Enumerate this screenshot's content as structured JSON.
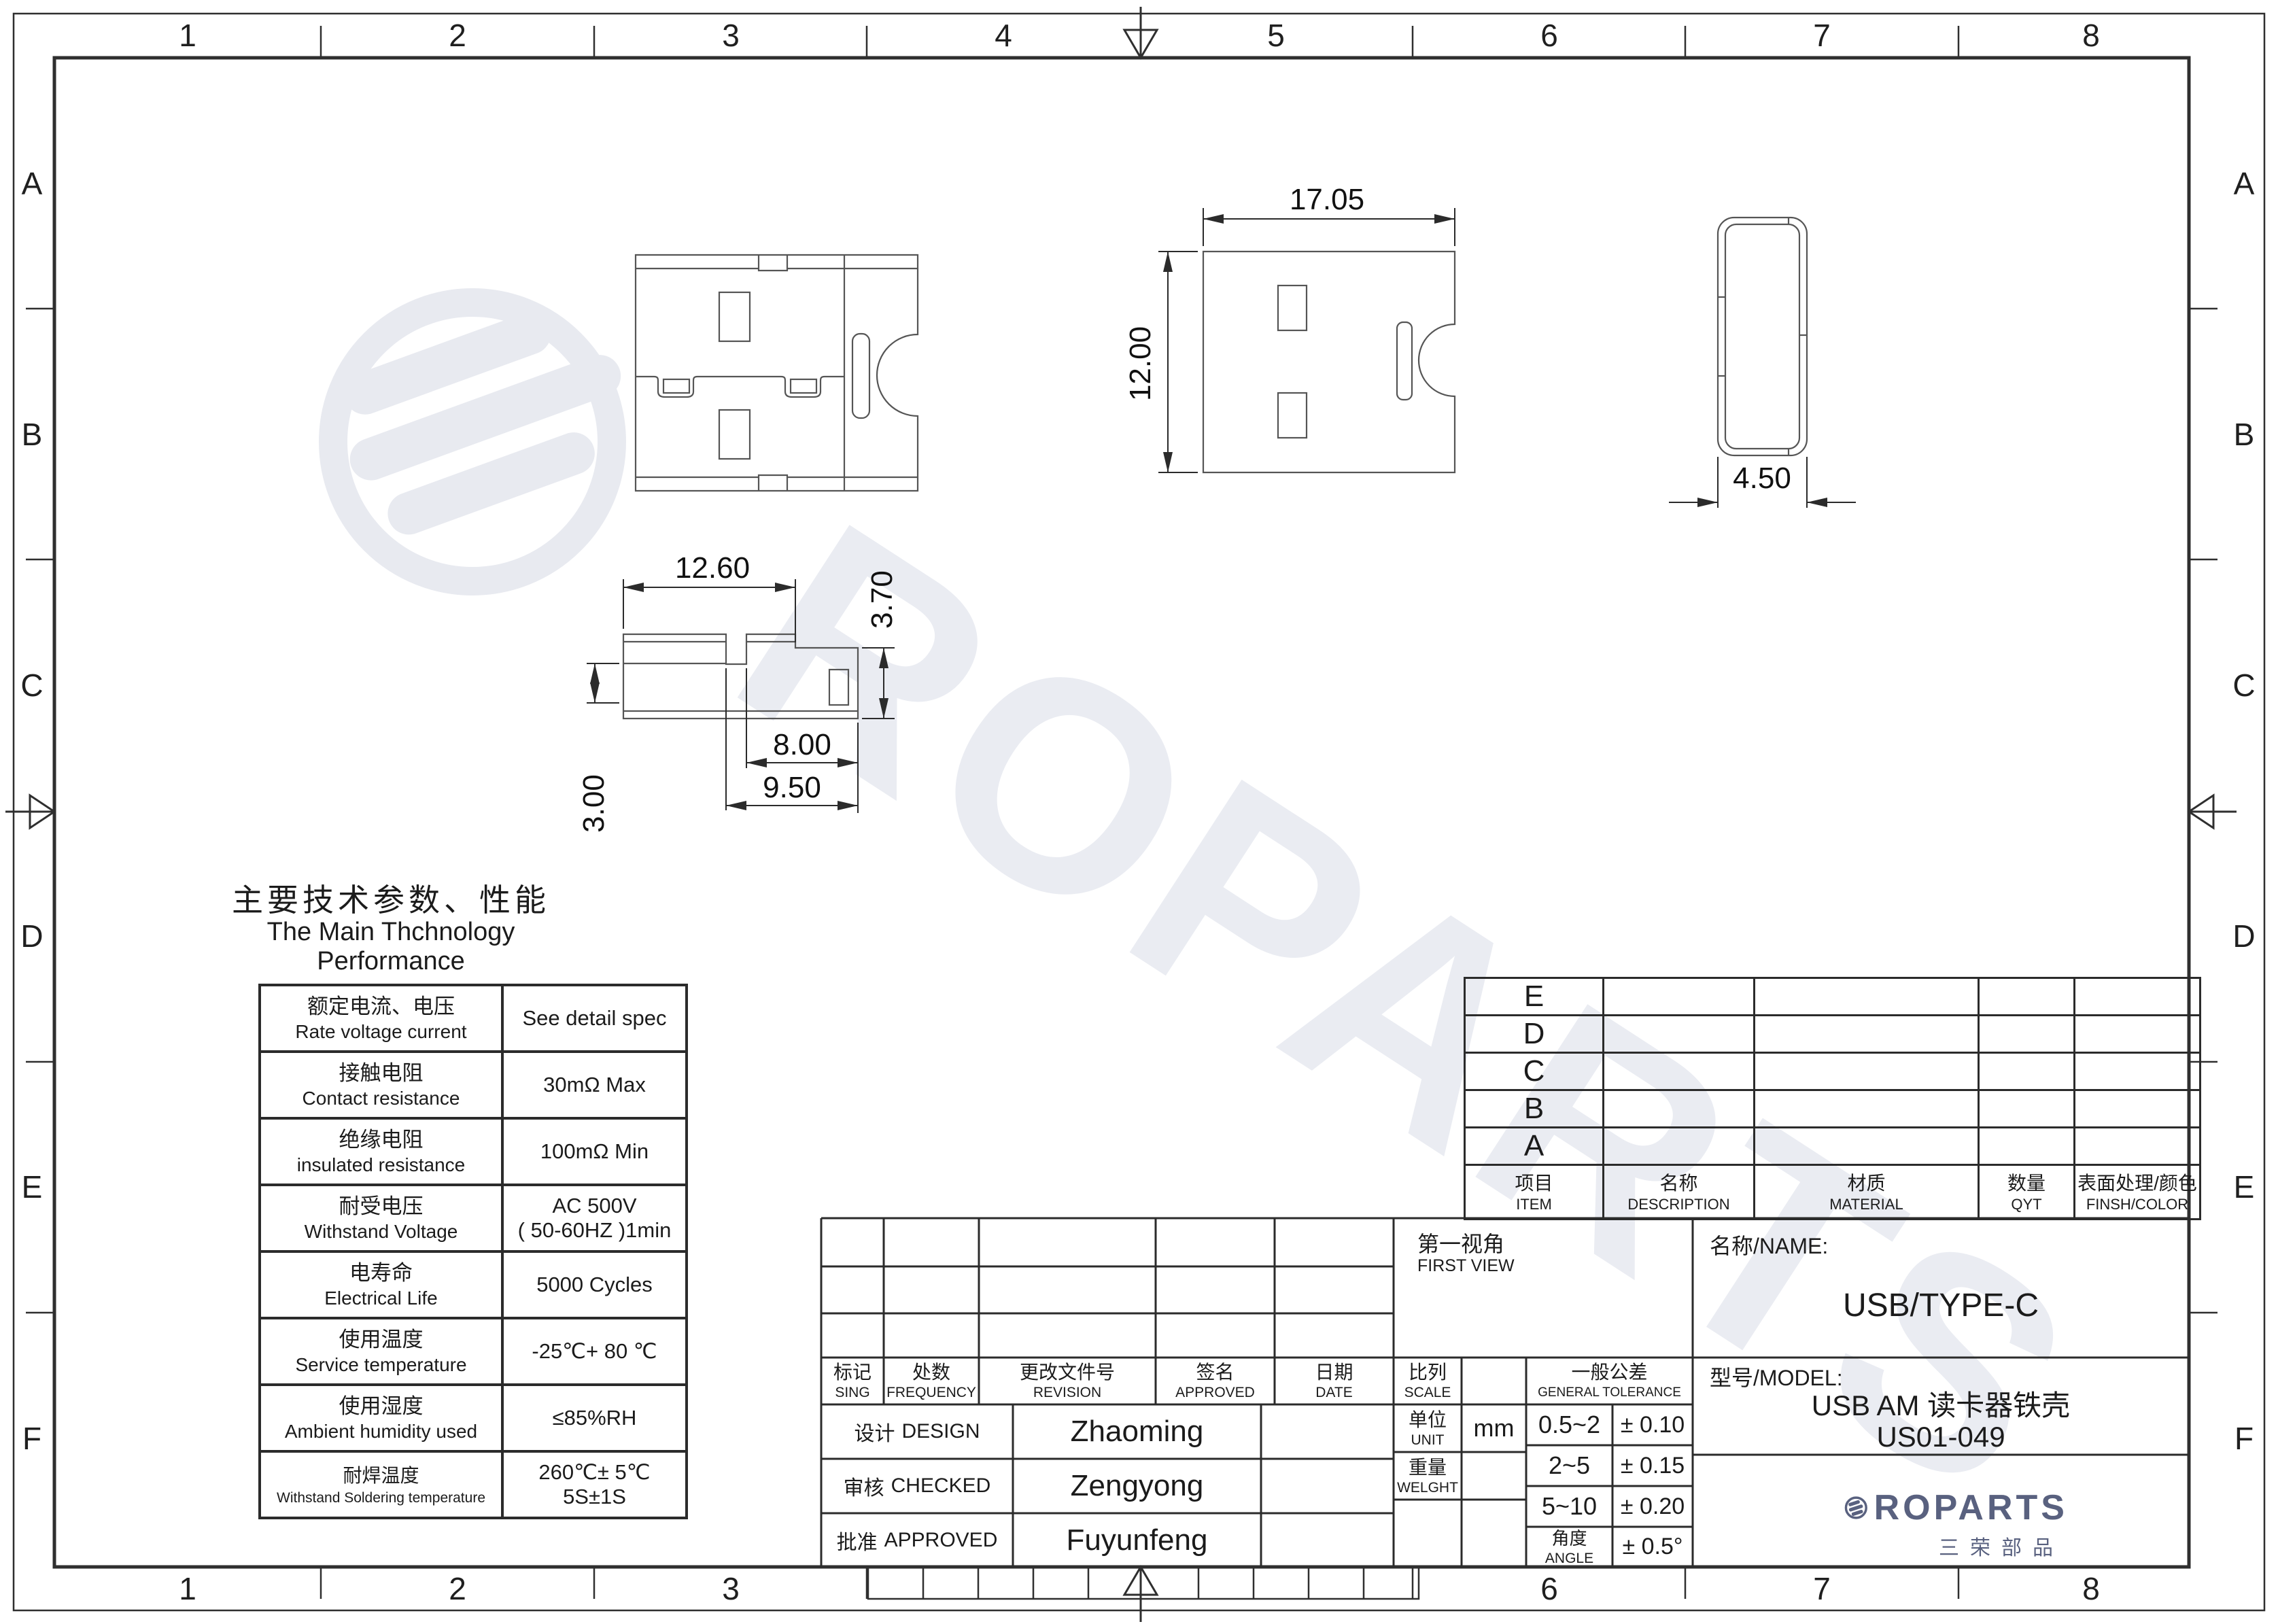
{
  "frame": {
    "top_numbers": [
      "1",
      "2",
      "3",
      "4",
      "5",
      "6",
      "7",
      "8"
    ],
    "bottom_numbers": [
      "1",
      "2",
      "3",
      "6",
      "7",
      "8"
    ],
    "left_letters": [
      "A",
      "B",
      "C",
      "D",
      "E",
      "F"
    ],
    "right_letters": [
      "A",
      "B",
      "C",
      "D",
      "E",
      "F"
    ]
  },
  "watermark": {
    "text": "ROPARTS"
  },
  "views": {
    "dims": {
      "plan_width": "17.05",
      "plan_height": "12.00",
      "end_width": "4.50",
      "side_width": "12.60",
      "side_height": "3.70",
      "side_len_inner": "8.00",
      "side_len_outer": "9.50",
      "side_left_height": "3.00"
    }
  },
  "performance": {
    "title_cn": "主要技术参数、性能",
    "title_en": "The Main Thchnology Performance",
    "rows": [
      {
        "cn": "额定电流、电压",
        "en": "Rate voltage current",
        "v1": "See detail spec",
        "v2": ""
      },
      {
        "cn": "接触电阻",
        "en": "Contact resistance",
        "v1": "30mΩ Max",
        "v2": ""
      },
      {
        "cn": "绝缘电阻",
        "en": "insulated resistance",
        "v1": "100mΩ Min",
        "v2": ""
      },
      {
        "cn": "耐受电压",
        "en": "Withstand Voltage",
        "v1": "AC 500V",
        "v2": "( 50-60HZ )1min"
      },
      {
        "cn": "电寿命",
        "en": "Electrical Life",
        "v1": "5000 Cycles",
        "v2": ""
      },
      {
        "cn": "使用温度",
        "en": "Service temperature",
        "v1": "-25℃+ 80 ℃",
        "v2": ""
      },
      {
        "cn": "使用湿度",
        "en": "Ambient humidity used",
        "v1": "≤85%RH",
        "v2": ""
      },
      {
        "cn": "耐焊温度",
        "en": "Withstand Soldering temperature",
        "v1": "260℃± 5℃",
        "v2": "5S±1S"
      }
    ]
  },
  "bom": {
    "row_labels": [
      "E",
      "D",
      "C",
      "B",
      "A"
    ],
    "headers": [
      {
        "cn": "项目",
        "en": "ITEM"
      },
      {
        "cn": "名称",
        "en": "DESCRIPTION"
      },
      {
        "cn": "材质",
        "en": "MATERIAL"
      },
      {
        "cn": "数量",
        "en": "QYT"
      },
      {
        "cn": "表面处理/颜色",
        "en": "FINSH/COLOR"
      }
    ]
  },
  "titleblock": {
    "rev_headers": [
      {
        "cn": "标记",
        "en": "SING"
      },
      {
        "cn": "处数",
        "en": "FREQUENCY"
      },
      {
        "cn": "更改文件号",
        "en": "REVISION"
      },
      {
        "cn": "签名",
        "en": "APPROVED"
      },
      {
        "cn": "日期",
        "en": "DATE"
      }
    ],
    "signoff": [
      {
        "cn": "设计",
        "en": "DESIGN",
        "name": "Zhaoming"
      },
      {
        "cn": "审核",
        "en": "CHECKED",
        "name": "Zengyong"
      },
      {
        "cn": "批准",
        "en": "APPROVED",
        "name": "Fuyunfeng"
      }
    ],
    "first_view": {
      "cn": "第一视角",
      "en": "FIRST VIEW"
    },
    "scale": {
      "cn": "比列",
      "en": "SCALE",
      "value": ""
    },
    "unit": {
      "cn": "单位",
      "en": "UNIT",
      "value": "mm"
    },
    "weight": {
      "cn": "重量",
      "en": "WELGHT",
      "value": ""
    },
    "tolerance": {
      "header_cn": "一般公差",
      "header_en": "GENERAL TOLERANCE",
      "rows": [
        {
          "range": "0.5~2",
          "tol": "± 0.10"
        },
        {
          "range": "2~5",
          "tol": "± 0.15"
        },
        {
          "range": "5~10",
          "tol": "± 0.20"
        },
        {
          "range_cn": "角度",
          "range_en": "ANGLE",
          "tol": "± 0.5°"
        }
      ]
    },
    "name_label": "名称/NAME:",
    "name_value": "USB/TYPE-C",
    "model_label": "型号/MODEL:",
    "model_value_line1": "USB AM 读卡器铁壳",
    "model_value_line2": "US01-049"
  },
  "brand": {
    "wordmark": "ROPARTS",
    "cn": "三荣部品"
  }
}
